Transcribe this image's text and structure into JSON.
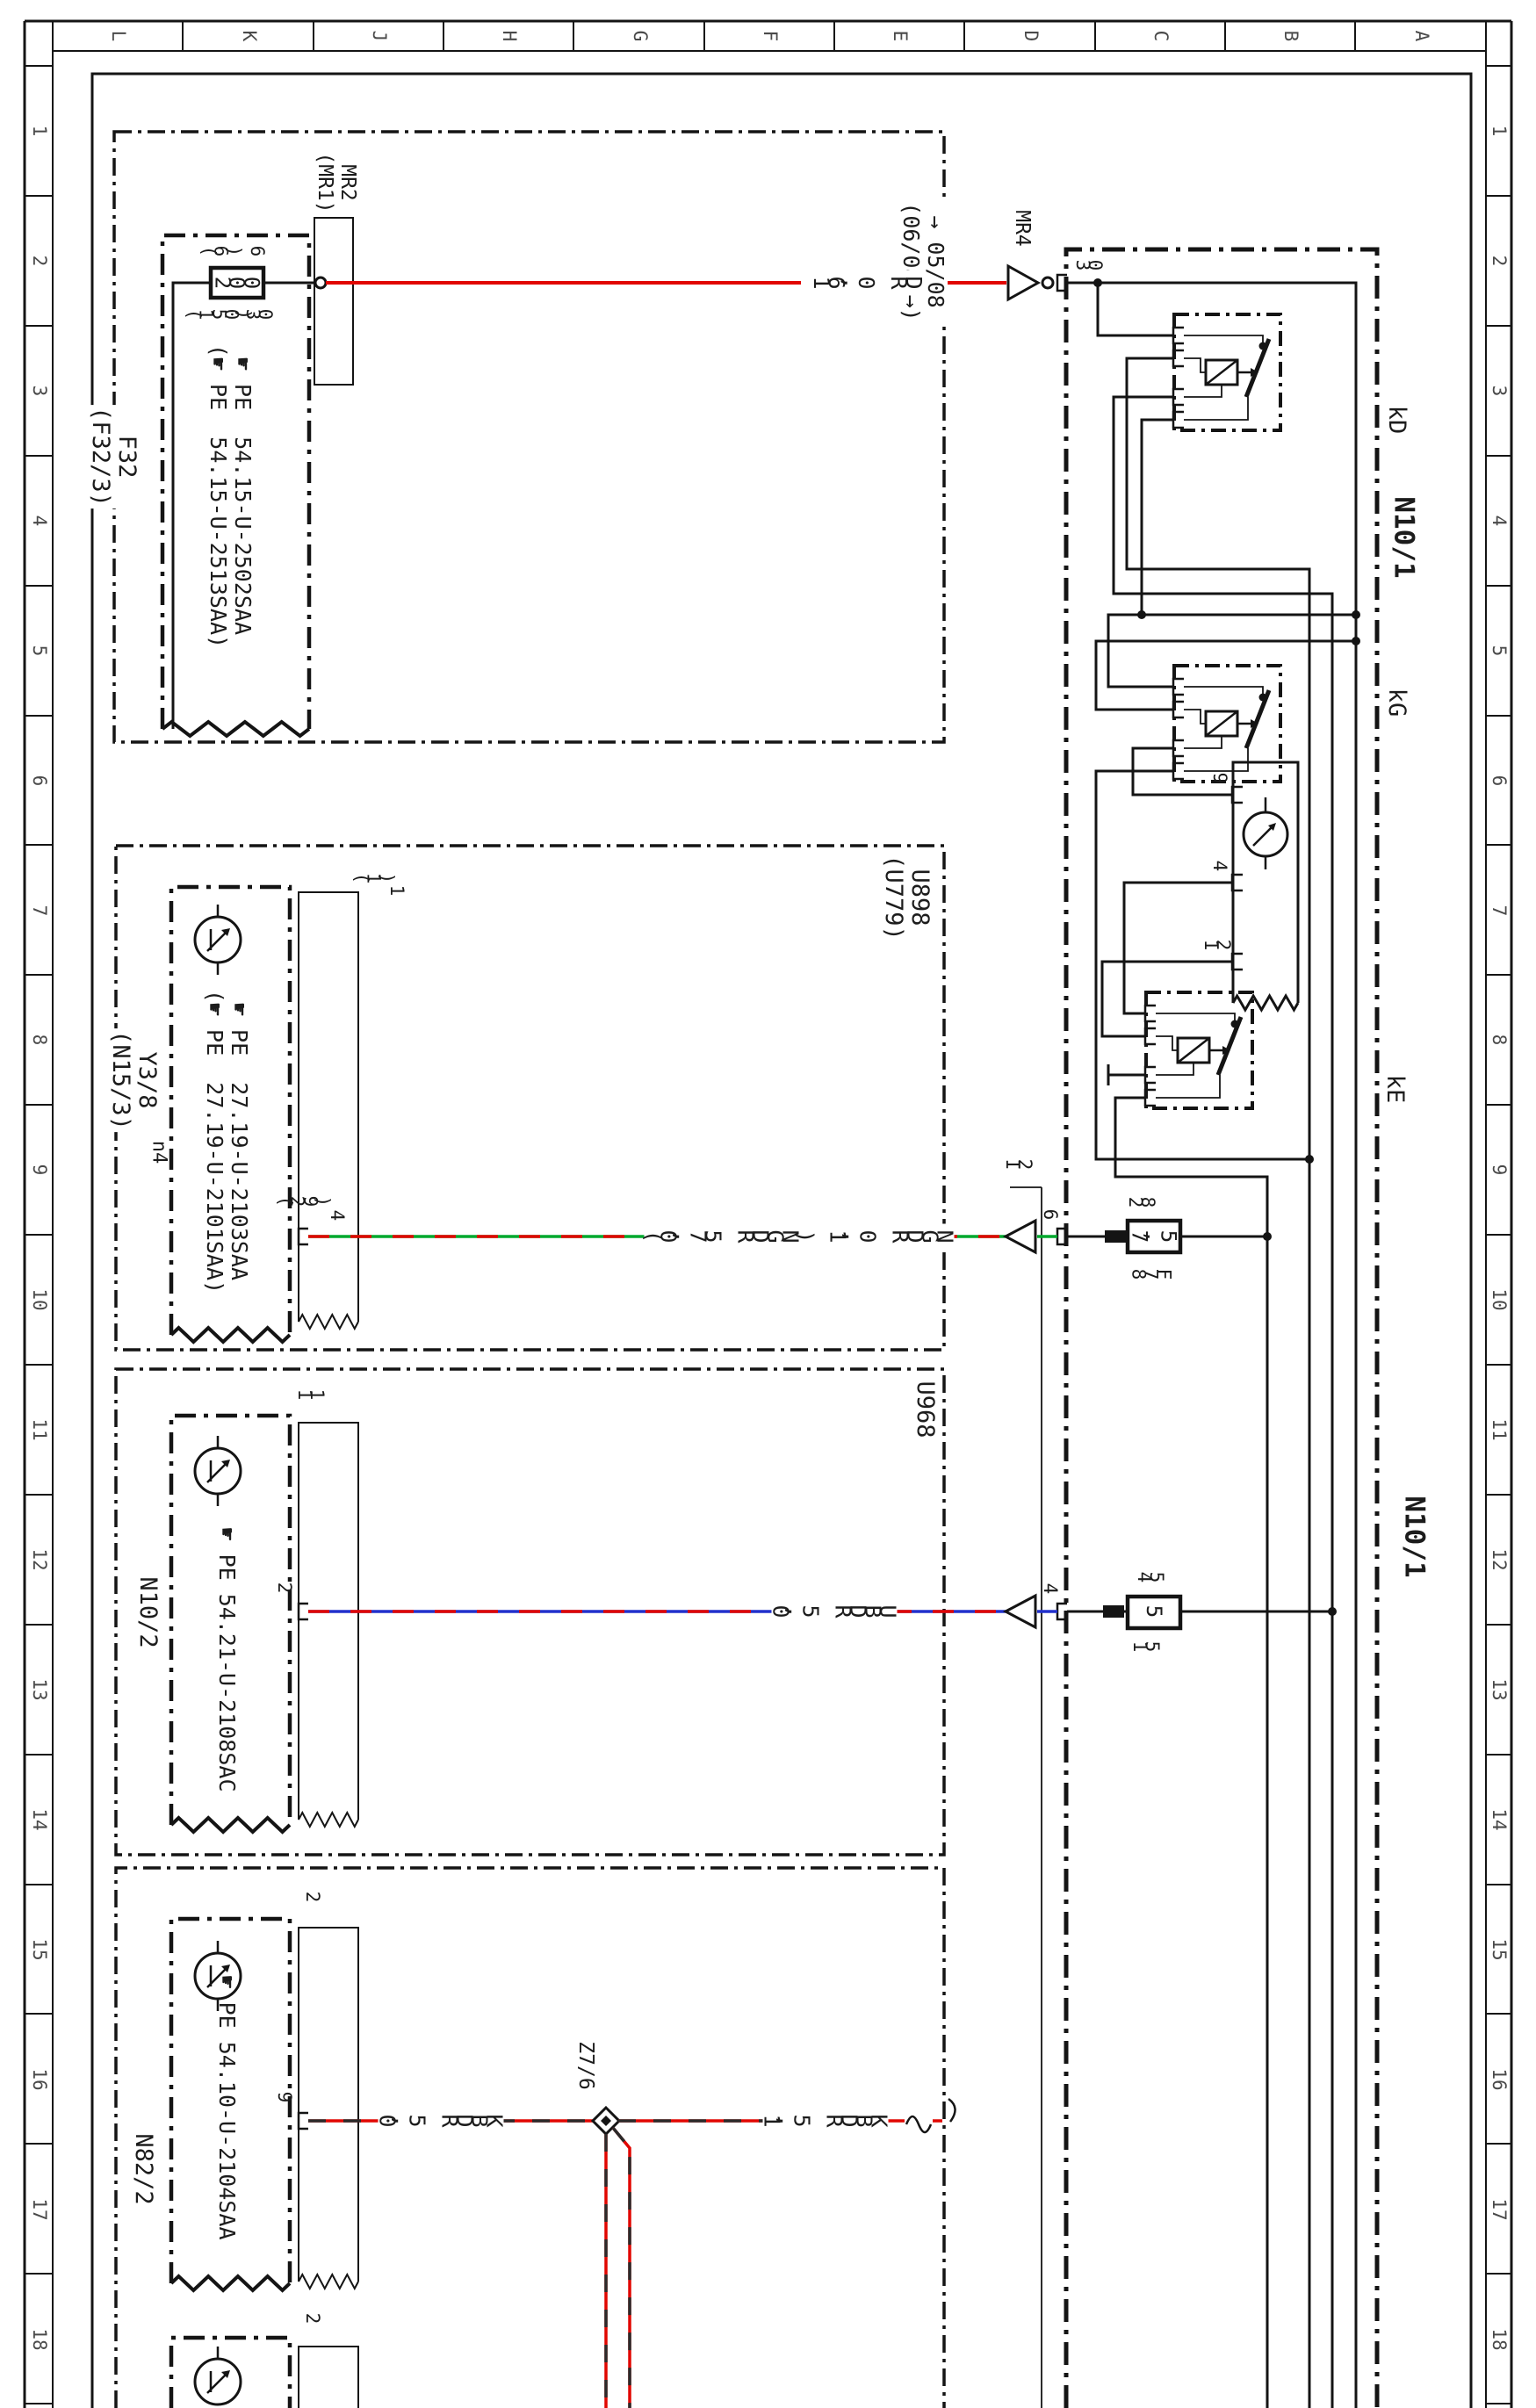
{
  "frame": {
    "columns": [
      "L",
      "K",
      "J",
      "H",
      "G",
      "F",
      "E",
      "D",
      "C",
      "B",
      "A"
    ],
    "rows": [
      "1",
      "2",
      "3",
      "4",
      "5",
      "6",
      "7",
      "8",
      "9",
      "10",
      "11",
      "12",
      "13",
      "14",
      "15",
      "16",
      "17",
      "18"
    ]
  },
  "icons": {
    "hand": "☛",
    "direction_arrow": "triangle",
    "splice": "diamond"
  },
  "colors": {
    "wire_red": "#e10600",
    "wire_green": "#00a82d",
    "wire_blue": "#2230cc",
    "wire_black": "#2a2a2a",
    "line": "#141414"
  },
  "f32": {
    "name": "F32",
    "name_alt": "(F32/3)",
    "connector": "MR2",
    "connector_alt": "(MR1)",
    "fuse": {
      "value": "200",
      "in": "6",
      "in_alt": "(6)",
      "out": "30",
      "out_alt": "(150)"
    },
    "pe": "☛ PE  54.15-U-2502SAA",
    "pe_alt": "(☛ PE  54.15-U-2513SAA)",
    "version": "→ 05/08",
    "version_alt": "(06/08 →)",
    "wire": "16,0  RD",
    "arrow_label": "MR4"
  },
  "n10_1": {
    "name": "N10/1",
    "pin30": "30",
    "relay_kd": "kD",
    "relay_kg": "kG",
    "relay_ke": "kE",
    "lamp_pin_9": "9",
    "lamp_pin_4": "4",
    "lamp_pin_12": "12",
    "fuse_75": {
      "top": "28",
      "value": "7,5",
      "bottom": "87F"
    },
    "pin6": "6",
    "connector_i2": "I2",
    "fuse_5": {
      "top": "45",
      "value": "5",
      "bottom": "15"
    },
    "pin4": "4"
  },
  "u898": {
    "name": "U898",
    "name_alt": "(U779)",
    "component": "Y3/8",
    "component_alt": "(N15/3)",
    "sub": "n4",
    "pe": "☛ PE  27.19-U-2103SAA",
    "pe_alt": "(☛ PE  27.19-U-2101SAA)",
    "plate_pin": "1",
    "plate_pin_alt": "(1)",
    "pin": "4",
    "pin_alt": "(29)",
    "wire": "(0,75  RDGN)  1,0  RDGN"
  },
  "u968": {
    "name": "U968",
    "component": "N10/2",
    "plate_pin": "11",
    "pe": "☛ PE  54.21-U-2108SAC",
    "pin": "2",
    "wire": "0,5  RDBU"
  },
  "n82_2": {
    "component": "N82/2",
    "plate_pin": "2",
    "pe": "☛ PE  54.10-U-2104SAA",
    "pin": "9",
    "wire_1": "0,5  RDBK",
    "connector": "Z7/6",
    "wire_2": "1,5  RDBK",
    "plate_pin_2": "2"
  }
}
